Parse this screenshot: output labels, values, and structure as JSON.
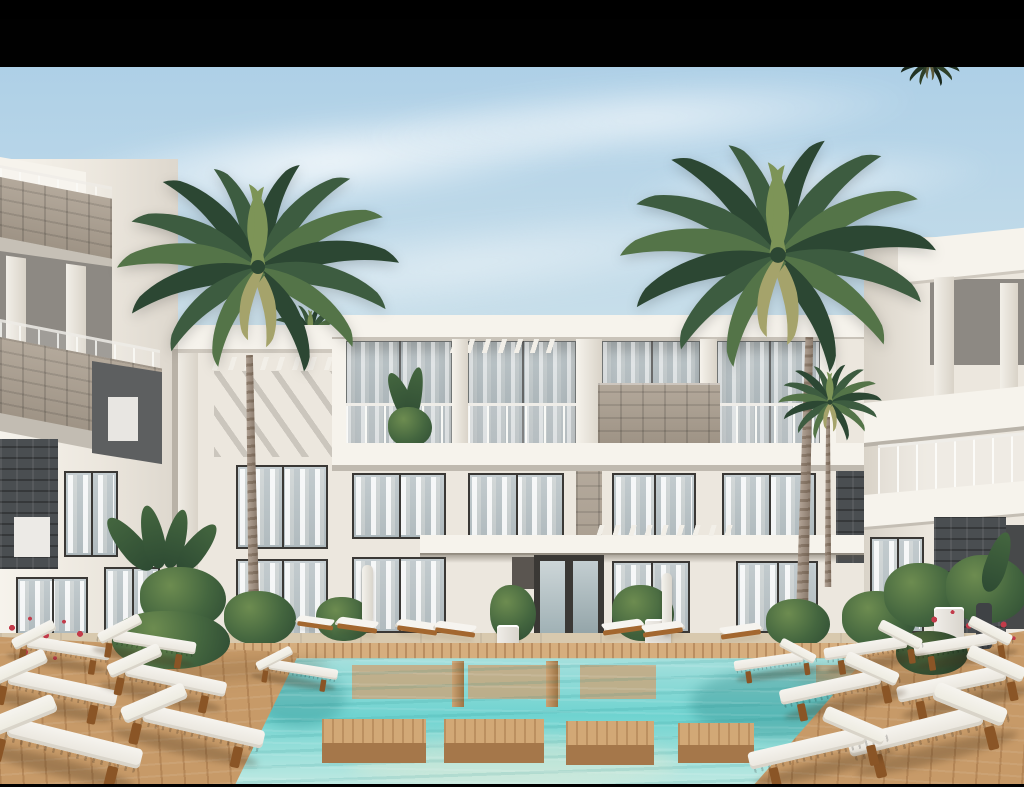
{
  "scene": {
    "type": "architectural-render",
    "description": "3D architectural rendering of a modern three-storey white resort apartment complex around a turquoise swimming-pool courtyard, with wooden sun decks, rows of white cushioned sun loungers, tropical plants, red flowers and two tall palm trees under a hazy blue sky with black letterbox bars",
    "time_of_day": "day",
    "letterbox": {
      "top_px": 48,
      "bottom_px": 3
    },
    "elements": [
      "sky",
      "clouds",
      "letterbox-bars",
      "left-apartment-wing",
      "central-apartment-block",
      "right-apartment-wing",
      "stone-clad-balconies",
      "glass-balustrades",
      "pergola-fins",
      "floor-to-ceiling-windows",
      "sheer-curtains",
      "entrance-doorway",
      "entrance-canopy",
      "palm-trees",
      "tropical-plants",
      "red-flowers",
      "white-planters",
      "bollard-lamps",
      "swimming-pool",
      "underwater-wood-platforms",
      "stepping-platforms",
      "wooden-decks",
      "sun-loungers"
    ]
  },
  "colors": {
    "sky_top": "#a9cde6",
    "sky_mid": "#c9dfea",
    "sky_low": "#e4edf0",
    "cloud": "#ffffff",
    "bar": "#010101",
    "wall": "#ece7de",
    "wall_lit": "#f6f3ec",
    "wall_shade": "#d9d3c8",
    "soffit": "#c6c0b6",
    "recess": "#8d8983",
    "recess_dark": "#5d5f60",
    "frame": "#3a3835",
    "curtain": "#e9e7e2",
    "glass": "#b7c1c5",
    "stone": "#ab9f90",
    "stone_dark": "#8f8376",
    "slate": "#4a4e51",
    "wood": "#c79a68",
    "wood_dark": "#a5774a",
    "coping": "#d6ae7e",
    "lounger_wood": "#a3672f",
    "lounger_wood_dark": "#8a5526",
    "cushion": "#f6f4ef",
    "cushion_shade": "#d9d4c9",
    "water_far": "#a7e0dd",
    "water_mid": "#6fd3d0",
    "water_near": "#c2eae3",
    "palm_dark": "#2c4733",
    "palm_mid": "#3d5c40",
    "palm_light": "#547448",
    "palm_accent": "#7d9457",
    "palm_dry": "#a5a36b",
    "trunk": "#a5917f",
    "trunk_dark": "#7c6c5c",
    "leaf_dark": "#2e4b33",
    "leaf_mid": "#44663f",
    "leaf_light": "#6d8c50",
    "flower_red": "#c23b4a",
    "planter_white": "#f0ede8",
    "bollard_dark": "#3f4245",
    "mountain": "#d9e4ea",
    "ground": "#d8c9ae"
  }
}
